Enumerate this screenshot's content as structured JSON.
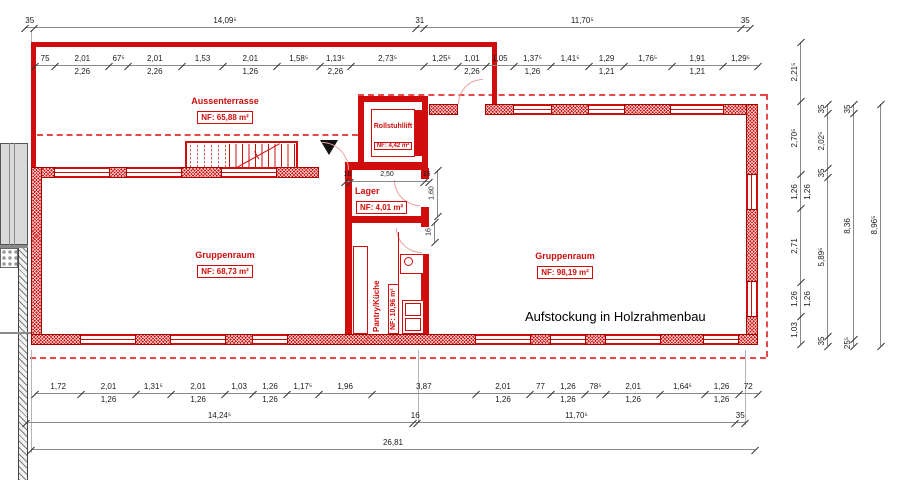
{
  "texts": {
    "annotation": "Aufstockung in Holzrahmenbau"
  },
  "colors": {
    "wall_red": "#cf0d0d",
    "dashed_red": "#e84848",
    "dim_text": "#1a1a1a"
  },
  "rooms": {
    "terrasse": {
      "name": "Aussenterrasse",
      "area": "NF:  65,88 m²"
    },
    "lift": {
      "name": "Rollstuhllift",
      "area": "NF:  4,42 m²"
    },
    "lager": {
      "name": "Lager",
      "area": "NF: 4,01 m²"
    },
    "pantry": {
      "name": "Pantry/Küche",
      "area": "NF: 10,96 m²"
    },
    "gruppe_l": {
      "name": "Gruppenraum",
      "area": "NF: 68,73 m²"
    },
    "gruppe_r": {
      "name": "Gruppenraum",
      "area": "NF: 98,19 m²"
    }
  },
  "dims": {
    "topOuter": [
      {
        "v": "35"
      },
      {
        "v": "14,09⁵"
      },
      {
        "v": "31"
      },
      {
        "v": "11,70⁵"
      },
      {
        "v": "35"
      }
    ],
    "topInner": [
      {
        "v": "75"
      },
      {
        "v": "2,01",
        "sub": "2,26"
      },
      {
        "v": "67⁵"
      },
      {
        "v": "2,01",
        "sub": "2,26"
      },
      {
        "v": "1,53"
      },
      {
        "v": "2,01",
        "sub": "1,26"
      },
      {
        "v": "1,58⁵"
      },
      {
        "v": "1,13⁵",
        "sub": "2,26"
      },
      {
        "v": "2,73⁵"
      },
      {
        "v": "1,25⁵"
      },
      {
        "v": "1,01",
        "sub": "2,26"
      },
      {
        "v": "1,05"
      },
      {
        "v": "1,37⁵",
        "sub": "1,26"
      },
      {
        "v": "1,41⁵"
      },
      {
        "v": "1,29",
        "sub": "1,21"
      },
      {
        "v": "1,76⁵"
      },
      {
        "v": "1,91",
        "sub": "1,21"
      },
      {
        "v": "1,29⁵"
      }
    ],
    "bottomInner": [
      {
        "v": "1,72"
      },
      {
        "v": "2,01",
        "sub": "1,26"
      },
      {
        "v": "1,31⁵"
      },
      {
        "v": "2,01",
        "sub": "1,26"
      },
      {
        "v": "1,03"
      },
      {
        "v": "1,26",
        "sub": "1,26"
      },
      {
        "v": "1,17⁵"
      },
      {
        "v": "1,96"
      },
      {
        "v": "3,87"
      },
      {
        "v": "2,01",
        "sub": "1,26"
      },
      {
        "v": "77"
      },
      {
        "v": "1,26",
        "sub": "1,26"
      },
      {
        "v": "78⁵"
      },
      {
        "v": "2,01",
        "sub": "1,26"
      },
      {
        "v": "1,64⁵"
      },
      {
        "v": "1,26",
        "sub": "1,26"
      },
      {
        "v": "72"
      }
    ],
    "bottomMid": [
      {
        "v": "14,24⁵"
      },
      {
        "v": "16"
      },
      {
        "v": "11,70⁵"
      },
      {
        "v": "35"
      }
    ],
    "bottomTotal": [
      {
        "v": "26,81"
      }
    ],
    "rightA": [
      {
        "v": "2,21⁵"
      },
      {
        "v": "2,70⁵"
      },
      {
        "v": "1,26",
        "sub": "1,26"
      },
      {
        "v": "2,71"
      },
      {
        "v": "1,26",
        "sub": "1,26"
      },
      {
        "v": "1,03"
      }
    ],
    "rightB": [
      {
        "v": "35"
      },
      {
        "v": "2,02⁵"
      },
      {
        "v": "35"
      },
      {
        "v": "5,89⁵"
      },
      {
        "v": "35"
      }
    ],
    "rightC": [
      {
        "v": "35"
      },
      {
        "v": "8,36"
      },
      {
        "v": "25⁵"
      }
    ],
    "rightD": [
      {
        "v": "8,96⁵"
      }
    ],
    "lagerWidth": [
      {
        "v": "16"
      },
      {
        "v": "2,50"
      },
      {
        "v": "16"
      }
    ],
    "lagerDepth": [
      {
        "v": "1,60"
      }
    ],
    "pantryDoorWall": [
      {
        "v": "16"
      }
    ]
  }
}
